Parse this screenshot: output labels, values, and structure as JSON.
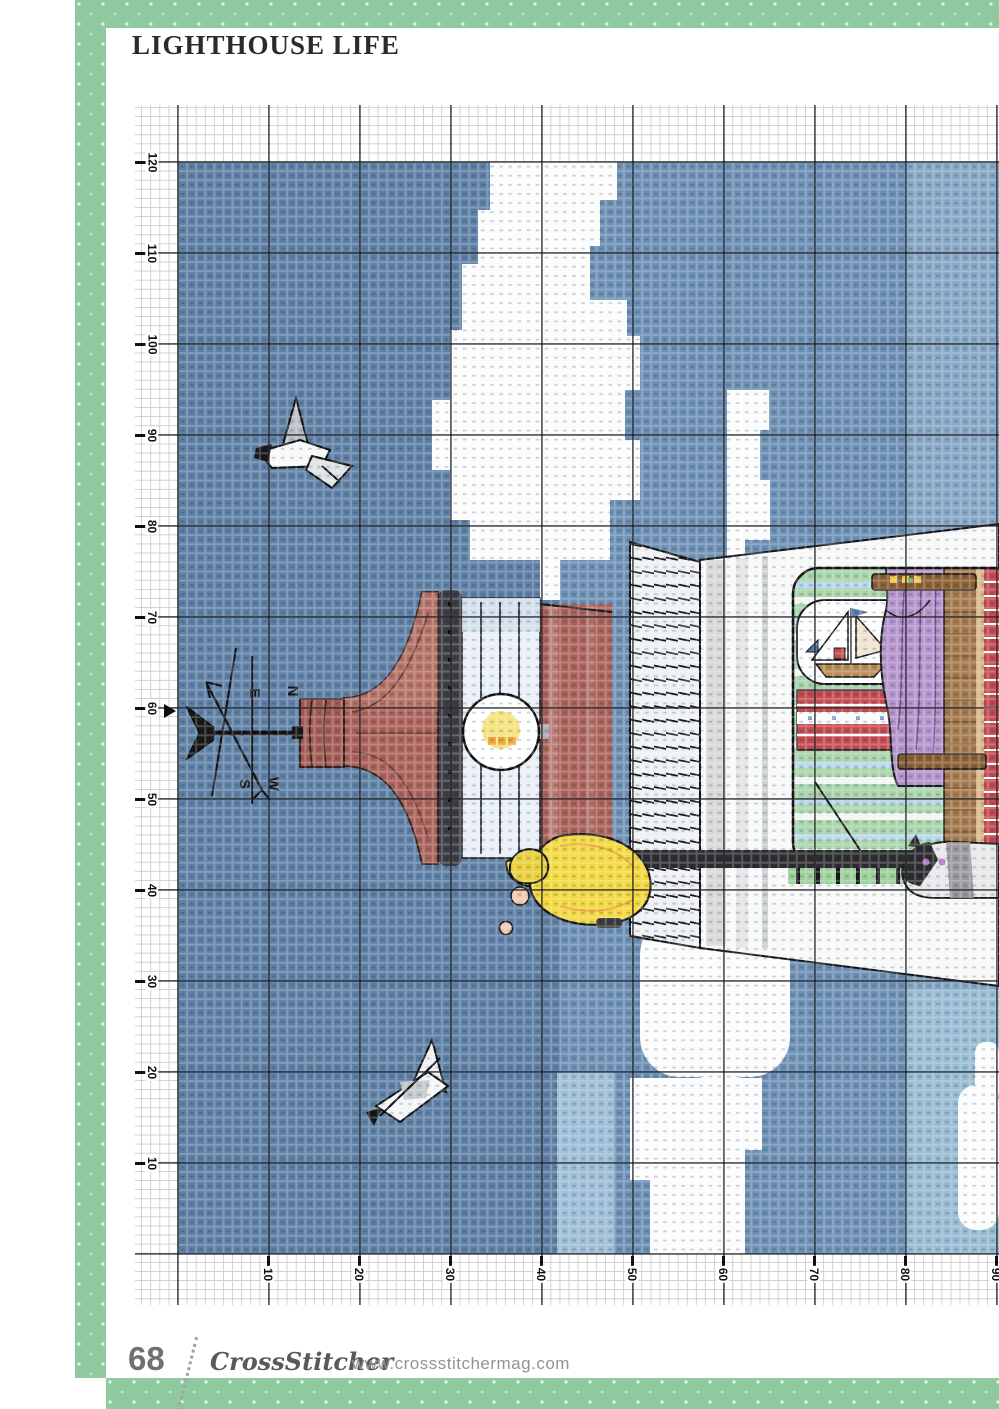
{
  "page": {
    "title": "LIGHTHOUSE LIFE",
    "page_number": "68",
    "magazine_name": "CrossStitcher",
    "website": "www.crossstitchermag.com"
  },
  "chart": {
    "kind": "cross-stitch pattern chart",
    "subject": "Lighthouse with red lantern roof, weather vane, keeper in yellow raincoat, cutaway room with sailboat picture, purple curtain and cat, clouds and two seagulls on blue sky (design rotated 90 degrees)",
    "grid": {
      "cell_px": 9.1,
      "major_line_every_cells": 10
    },
    "left_axis_labels": [
      "120",
      "110",
      "100",
      "90",
      "80",
      "70",
      "60",
      "50",
      "40",
      "30",
      "20",
      "10"
    ],
    "bottom_axis_labels": [
      "10",
      "20",
      "30",
      "40",
      "50",
      "60",
      "70",
      "80",
      "90"
    ],
    "compass": {
      "n": "N",
      "e": "E",
      "s": "S",
      "w": "W"
    }
  },
  "palette": {
    "frame_green": "#8fc9a0",
    "title_ink": "#2b2b2b",
    "grid_major": "#1c1c1e",
    "sky_dark": "#5e7fa4",
    "sky_mid": "#6c8fb3",
    "sky_light": "#85a6c4",
    "sky_patch": "#9dbdd6",
    "cloud_white": "#fbfcfd",
    "roof_red": "#a96159",
    "roof_red_light": "#c08274",
    "roof_red_dark": "#6f3b33",
    "rim_charcoal": "#3c3c42",
    "lantern_pane": "#e9eff6",
    "lantern_shade": "#cfdde9",
    "bulb_yellow": "#f6e27b",
    "bulb_orange": "#eda53c",
    "tower_white": "#f7f8f8",
    "tower_gray": "#d6d8d9",
    "railing_white": "#eef1f3",
    "deck_dark": "#2c2c30",
    "room_green": "#a9d4ab",
    "room_stripe_blue": "#b9d8ec",
    "brick_red": "#c24b52",
    "curtain_purple": "#b493cb",
    "curtain_fold": "#6e4f85",
    "wood_brown": "#a3794e",
    "wood_dark": "#8a5f33",
    "sand_tan": "#d8b88a",
    "coat_yellow": "#f2d841",
    "skin_pink": "#f3c8ad",
    "grass_green": "#9ccf9a",
    "accent_yellow": "#ecc84e",
    "gull_gray": "#c3c8cc",
    "ink_black": "#141417",
    "cat_gray": "#8f8f93",
    "cat_eye_purple": "#b06fc2",
    "footer_gray": "#6f7072",
    "footer_light_gray": "#919396",
    "logo_gray": "#58595b"
  }
}
